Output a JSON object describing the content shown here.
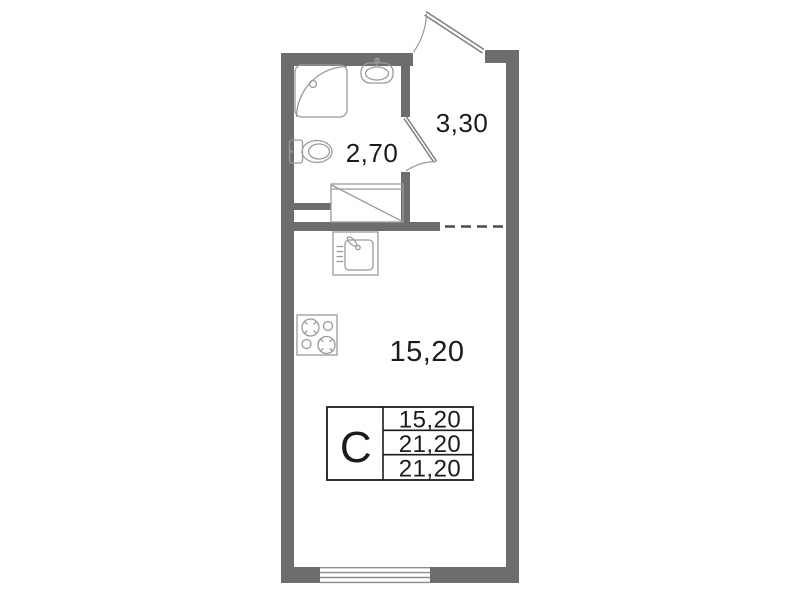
{
  "plan": {
    "type": "studio-apartment-floor-plan",
    "labels": {
      "bathroom": "2,70",
      "hallway": "3,30",
      "living": "15,20"
    },
    "legend": {
      "letter": "С",
      "rows": [
        "15,20",
        "21,20",
        "21,20"
      ]
    },
    "icons": {
      "shower-icon": "quarter-circle corner shower cabin",
      "washbasin-icon": "oval wall-hung basin with tap",
      "toilet-icon": "toilet with cistern",
      "kitchen-sink-icon": "square sink with tap and drainer ticks",
      "stove-icon": "4-burner cooktop",
      "wardrobe-icon": "closet rectangle with diagonal",
      "entrance-door-icon": "outward door swing arc",
      "bathroom-door-icon": "door swing arc into hallway",
      "window-icon": "4-line window in bottom wall",
      "partition-dashed-line": "virtual partition between hallway and living room"
    }
  },
  "colors": {
    "wall": "#6d6d6d",
    "fixture": "#9a9a9a",
    "door": "#7f7f7f",
    "ink": "#1b1b1b",
    "dash": "#4d4d4d",
    "window_line": "#8d8d8d",
    "background": "#ffffff"
  }
}
